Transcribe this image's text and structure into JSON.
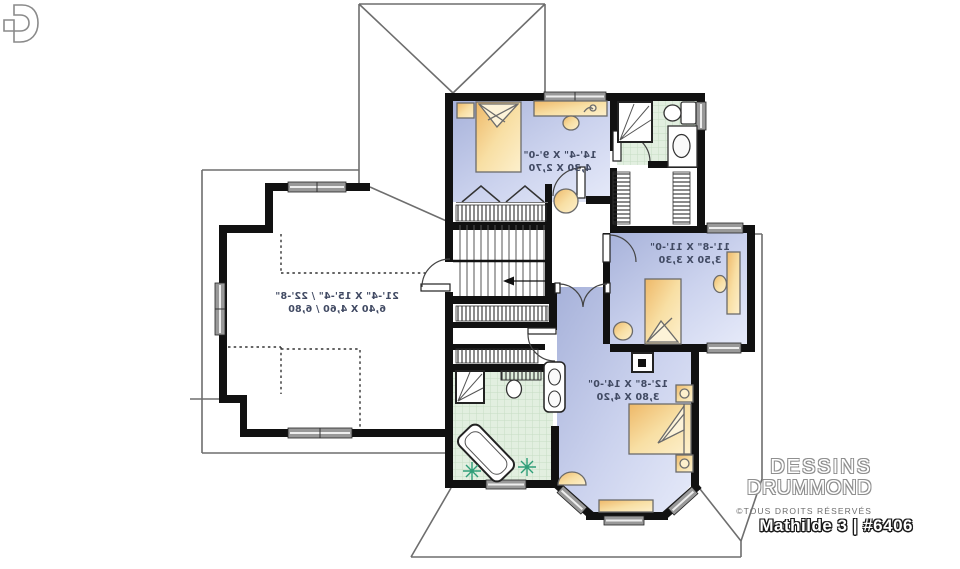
{
  "branding": {
    "name_line1": "DESSINS",
    "name_line2": "DRUMMOND",
    "rights": "©TOUS DROITS RÉSERVÉS",
    "plan_title": "Mathilde 3 | #6406",
    "logo": "drummond-d-monogram"
  },
  "rooms": {
    "bonus_over_garage": {
      "imperial": "21'-4\" X 15'-4\" / 22'-8\"",
      "metric": "6,40 X 4,60 / 6,80"
    },
    "bedroom_1": {
      "imperial": "14'-4\" X 9'-0\"",
      "metric": "4,30 X 2,70"
    },
    "bedroom_2": {
      "imperial": "11'-8\" X 11'-0\"",
      "metric": "3,50 X 3,30"
    },
    "master_bedroom": {
      "imperial": "12'-8\" X 14'-0\"",
      "metric": "3,80 X 4,20"
    }
  },
  "colors": {
    "walls": "#111111",
    "bedroom_floor": "#b9c3e6",
    "bathroom_floor": "#e2efe0",
    "furniture": "#f2d08a",
    "plant": "#2f9e78",
    "roof_lines": "#6e6e6e"
  }
}
